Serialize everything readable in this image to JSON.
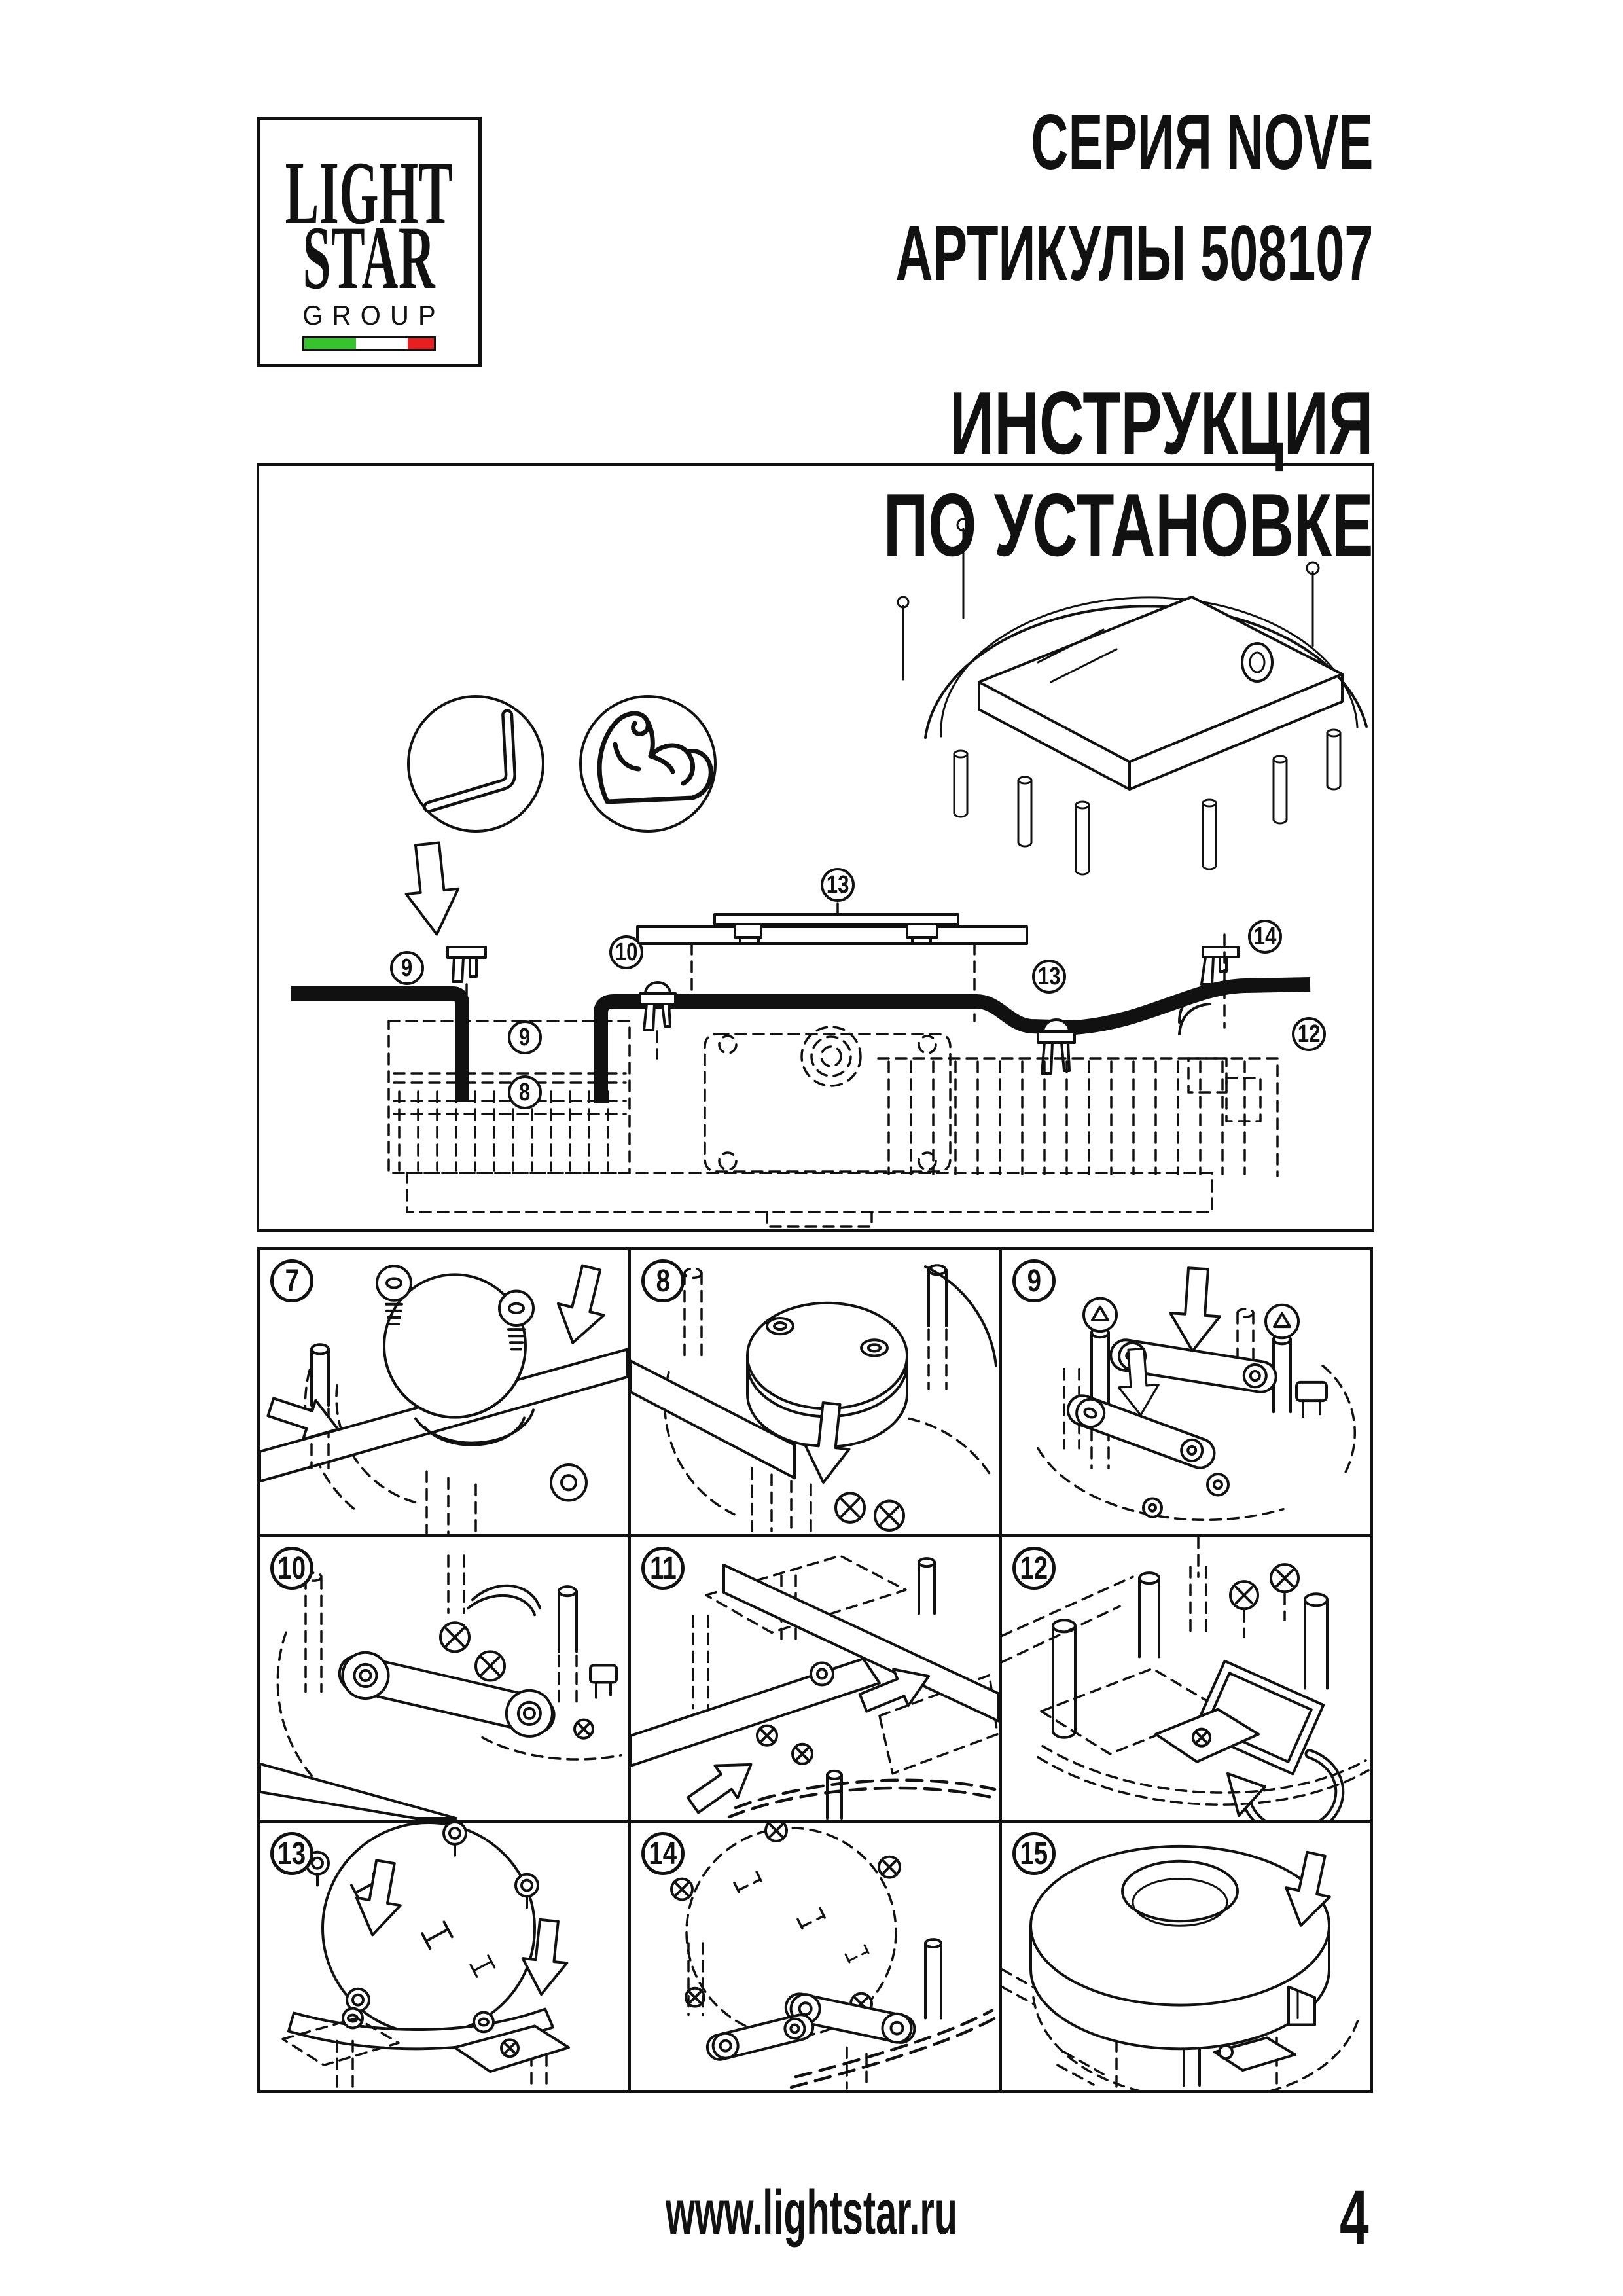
{
  "logo": {
    "line1": "LIGHT",
    "line2": "STAR",
    "line3": "GROUP"
  },
  "header": {
    "series": "СЕРИЯ NOVE",
    "articles": "АРТИКУЛЫ 508107",
    "instruction_line1": "ИНСТРУКЦИЯ",
    "instruction_line2": "ПО УСТАНОВКЕ"
  },
  "diagram": {
    "callouts": [
      "9",
      "10",
      "9",
      "8",
      "13",
      "13",
      "14",
      "12"
    ],
    "icons": [
      "allen-key",
      "muscle-strength"
    ]
  },
  "steps": [
    "7",
    "8",
    "9",
    "10",
    "11",
    "12",
    "13",
    "14",
    "15"
  ],
  "footer": {
    "website": "www.lightstar.ru",
    "page_number": "4"
  },
  "colors": {
    "ink": "#111111",
    "flag_green": "#35c42c",
    "flag_white": "#ffffff",
    "flag_red": "#e81e20"
  }
}
